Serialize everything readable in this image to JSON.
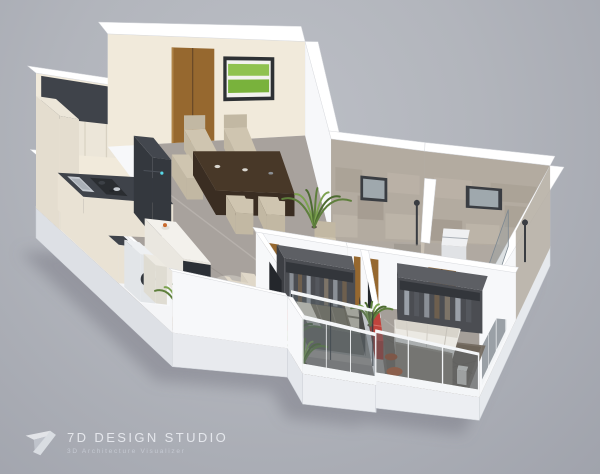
{
  "brand": {
    "name": "7D DESIGN STUDIO",
    "tagline": "3D Architecture Visualizer",
    "logomark": "7d-monogram"
  },
  "scene": {
    "type": "isometric-3d-floor-plan-render",
    "rooms": [
      {
        "name": "kitchen",
        "furniture": [
          "l-shaped-counter-dark-top",
          "gas-cooktop-with-pots",
          "sink",
          "refrigerator",
          "tall-cabinet",
          "upper-cabinets",
          "island-breakfast-counter"
        ]
      },
      {
        "name": "utility",
        "furniture": [
          "washing-machine",
          "storage-counter",
          "potted-palm"
        ]
      },
      {
        "name": "dining-area",
        "furniture": [
          "dark-wood-dining-table",
          "cream-chairs",
          "green-landscape-wall-art",
          "palm-plant",
          "cream-armchair"
        ]
      },
      {
        "name": "entrance",
        "furniture": [
          "wooden-double-door"
        ]
      },
      {
        "name": "living-room",
        "furniture": [
          "beige-l-sofa",
          "round-coffee-table",
          "gray-ottoman",
          "side-table",
          "dark-rug",
          "island-bar-panel"
        ]
      },
      {
        "name": "common-bathroom",
        "furniture": [
          "toilet",
          "wooden-vanity",
          "shower",
          "window",
          "tiled-walls"
        ]
      },
      {
        "name": "master-bathroom",
        "furniture": [
          "washbasin",
          "toilet",
          "shower",
          "glass-screen",
          "window",
          "tiled-walls"
        ]
      },
      {
        "name": "bedroom-1",
        "furniture": [
          "queen-bed-olive-bedding",
          "open-wardrobe-with-clothes",
          "red-bench",
          "wall-tv-panel",
          "palm-plant"
        ]
      },
      {
        "name": "master-bedroom",
        "furniture": [
          "king-bed-white-bedding",
          "dark-pillows",
          "open-wardrobe-with-clothes",
          "red-bench",
          "wall-tv-panel",
          "patterned-rug",
          "orange-armchair",
          "side-table",
          "palm-plant"
        ]
      },
      {
        "name": "deck-balcony",
        "furniture": [
          "wood-louver-deck",
          "parapet-wall",
          "large-palm-planter"
        ]
      },
      {
        "name": "bedroom-balcony",
        "furniture": [
          "glass-railing",
          "glass-partition",
          "small-palm"
        ]
      }
    ]
  },
  "colors": {
    "background": "#b3b6bd",
    "wall": "#f7f8fa",
    "wall_top": "#ffffff",
    "wall_cream": "#f1eadb",
    "floor_marble": "#a8a29d",
    "floor_bedroom": "#a39d97",
    "floor_bathroom": "#b0a9a1",
    "floor_balcony": "#8e8985",
    "deck_wood": "#8a5f35",
    "door_wood": "#96682f",
    "counter_dark": "#3f434a",
    "cabinet_cream": "#ece6d9",
    "island_bar": "#2c3036",
    "accent_red": "#c0443d",
    "accent_orange": "#b35a31",
    "sofa_beige": "#d7cfbf",
    "chair_cream": "#cfc5b0",
    "table_brown": "#483828",
    "bed_olive": "#797365",
    "bed_white": "#ebe9e3",
    "pillow_dark": "#424750",
    "rug_living": "#453f39",
    "rug_master": "#746b61",
    "wardrobe_gray": "#4b4d52",
    "tile_beige": "#b3aba0",
    "glass": "#8f9aa3",
    "tv_dark": "#24272c",
    "plant_green": "#5e7f3c",
    "art_green": "#79b23c",
    "logo_text": "#e8eaef",
    "logo_tagline": "#c7cbd4"
  }
}
